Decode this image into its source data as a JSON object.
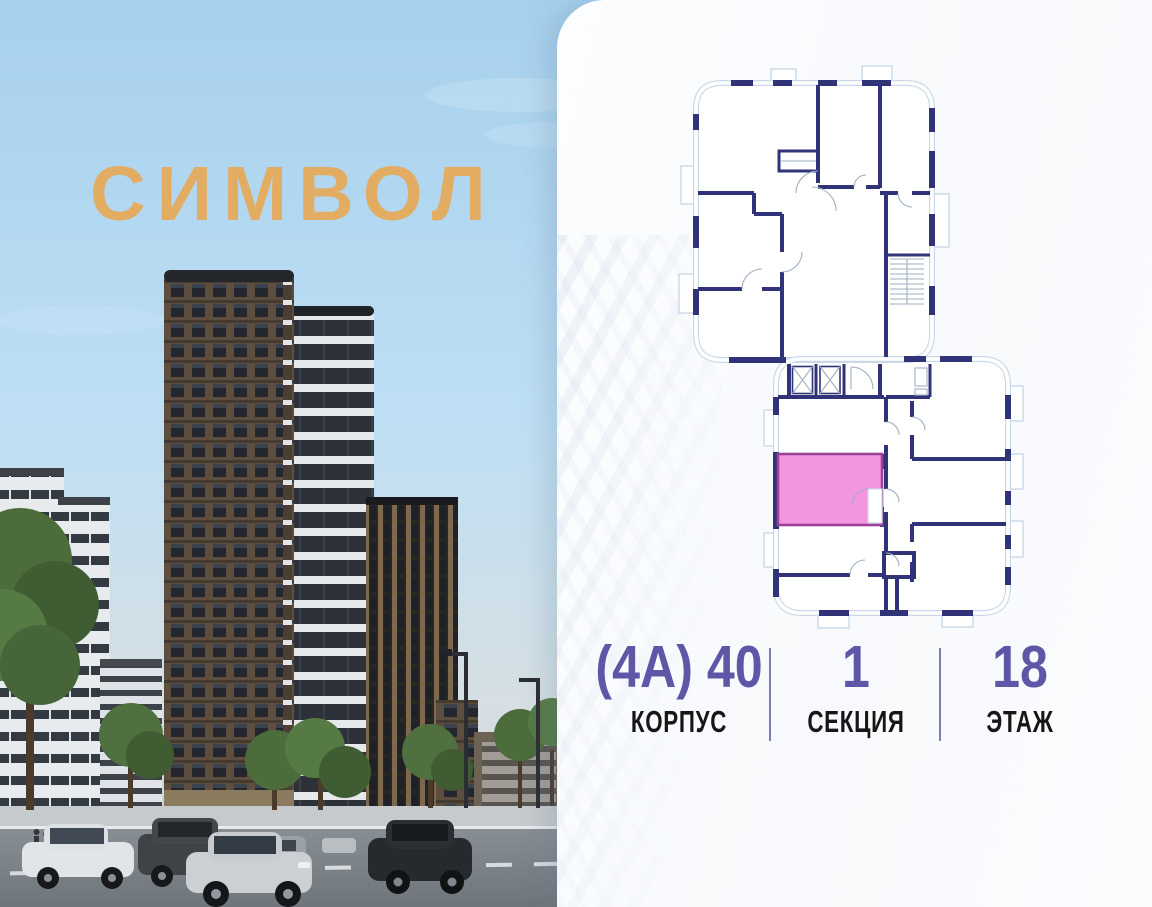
{
  "project": {
    "logo": "СИМВОЛ",
    "logo_color": "#e3ac63"
  },
  "plan": {
    "wall_color": "#303377",
    "outline_color": "#c9d9e8",
    "highlight_fill": "#f495e0",
    "highlight_border": "#9c4399"
  },
  "unit_info": {
    "value_color": "#5e57a8",
    "label_color": "#161616",
    "columns": [
      {
        "value": "(4А) 40",
        "label": "КОРПУС"
      },
      {
        "value": "1",
        "label": "СЕКЦИЯ"
      },
      {
        "value": "18",
        "label": "ЭТАЖ"
      }
    ]
  }
}
